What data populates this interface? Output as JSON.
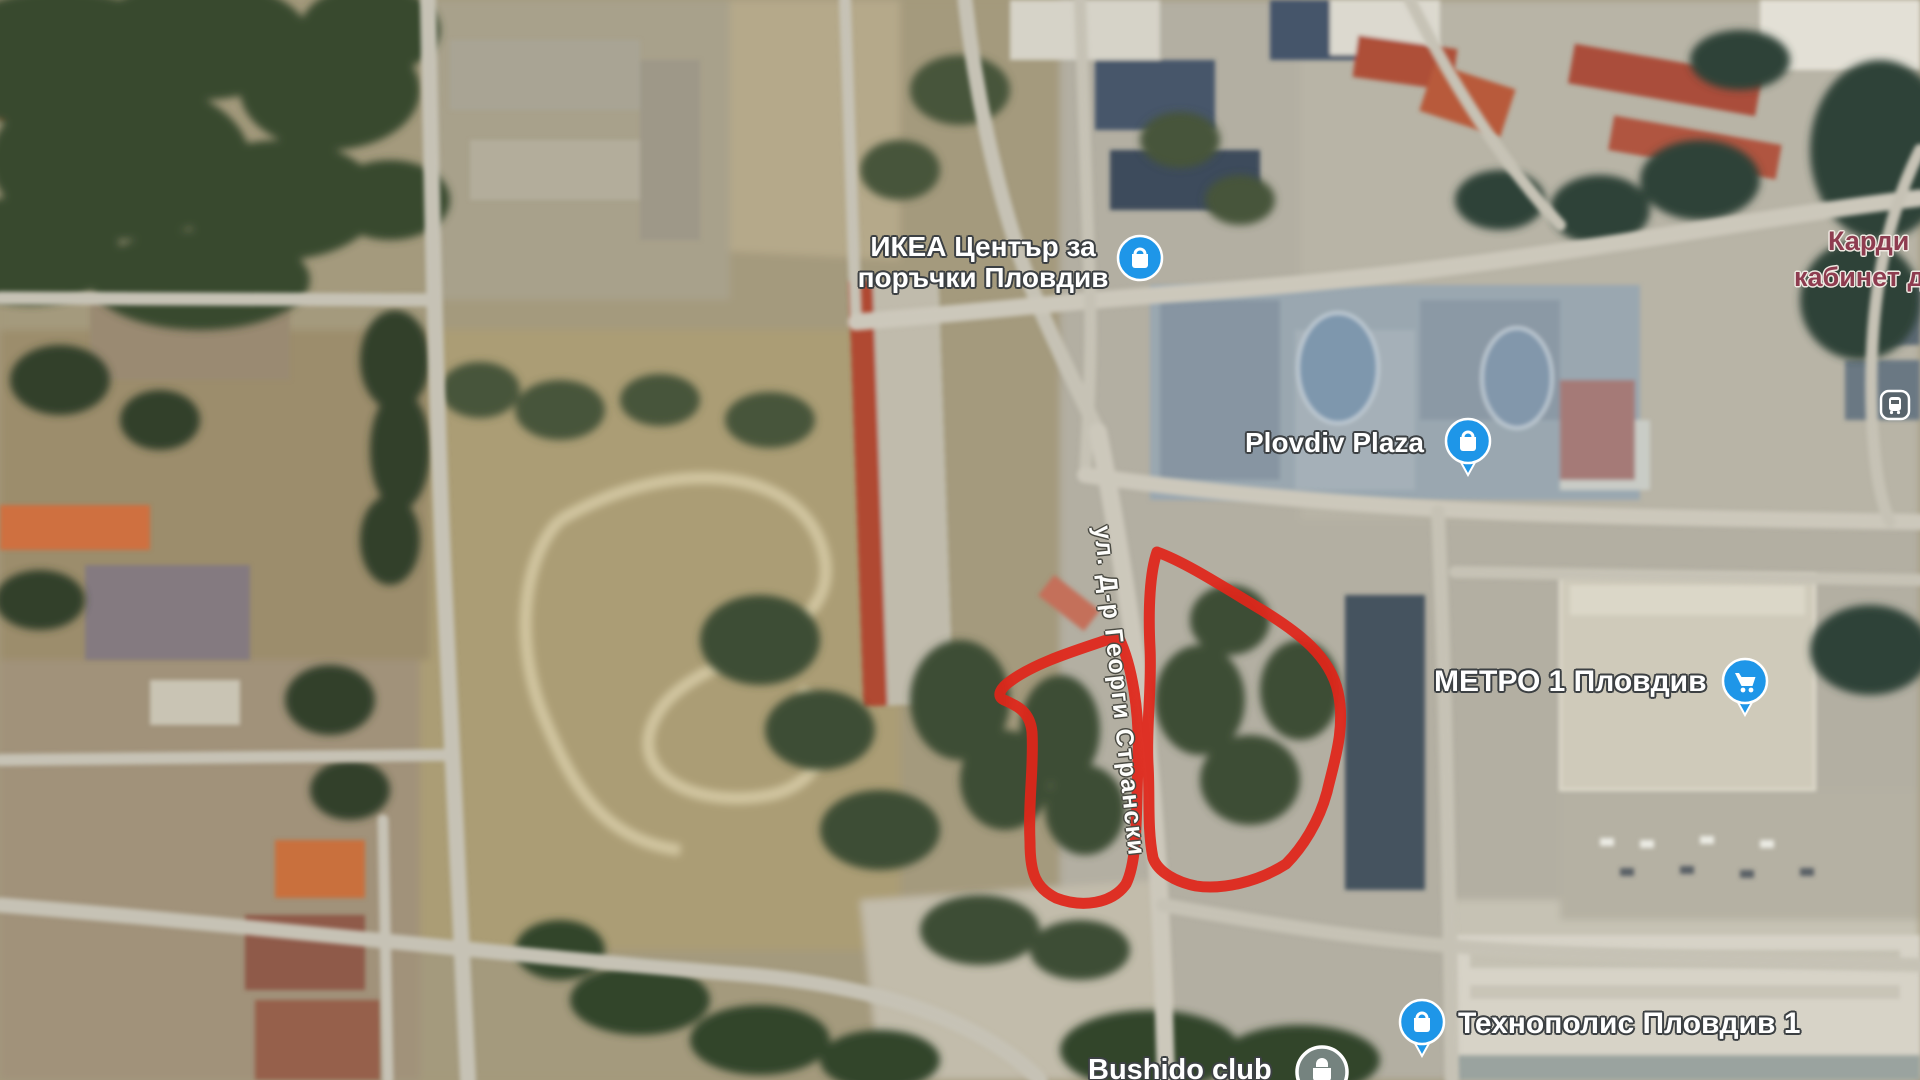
{
  "map": {
    "colors": {
      "annotation_red": "#e0261a",
      "poi_blue": "#1e96e8",
      "label_white": "#ffffff",
      "health_label_maroon": "#8e3c50",
      "road_gray": "#c6c2b5"
    }
  },
  "pois": {
    "ikea": {
      "label_line1": "ИКЕА Център за",
      "label_line2": "поръчки Пловдив",
      "icon": "shopping-bag-icon"
    },
    "plovdiv_plaza": {
      "label": "Plovdiv Plaza",
      "icon": "shopping-bag-pin-icon"
    },
    "metro": {
      "label": "МЕТРО 1 Пловдив",
      "icon": "shopping-cart-pin-icon"
    },
    "technopolis": {
      "label": "Технополис Пловдив 1",
      "icon": "shopping-bag-pin-icon"
    },
    "cardio": {
      "label_line1": "Карди",
      "label_line2": "кабинет д",
      "icon": "none"
    },
    "bushido": {
      "label": "Bushido club",
      "icon": "poi-circle-icon"
    },
    "bus_stop": {
      "icon": "bus-stop-icon"
    }
  },
  "streets": {
    "main_street": "ул. Д-р Георги Странски"
  },
  "annotations": {
    "areas_outlined": "2"
  }
}
